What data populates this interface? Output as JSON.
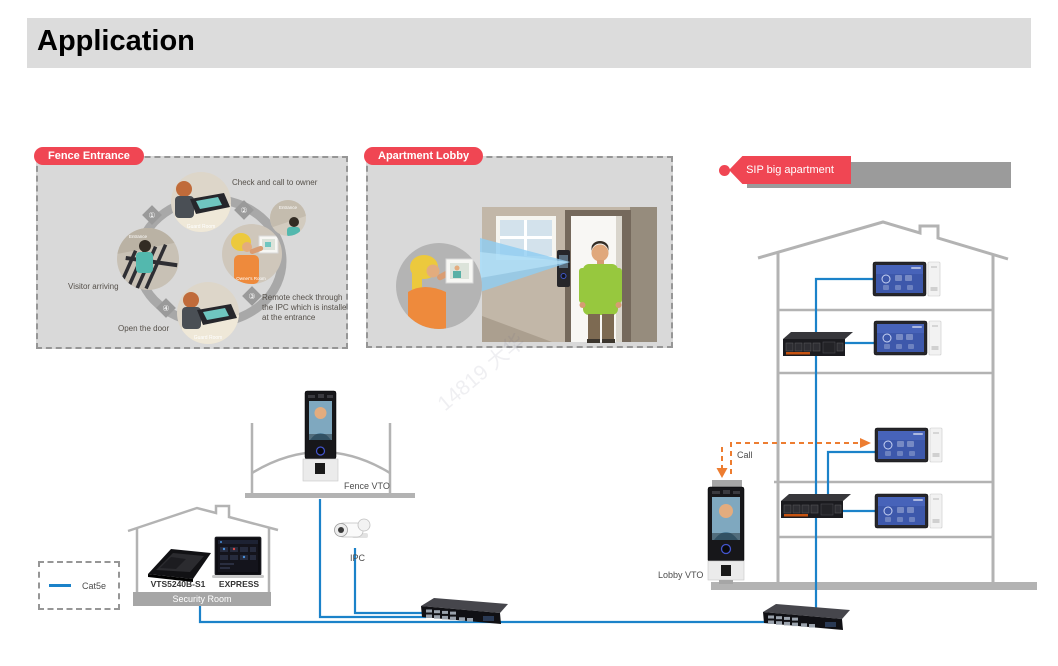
{
  "title": "Application",
  "watermark": "14819 大华",
  "colors": {
    "accent_red": "#f04653",
    "line_blue": "#1b82c9",
    "call_orange": "#ed7d31",
    "bar_gray": "#a6a6a6",
    "panel_gray": "#d9d9d9",
    "outline_gray": "#b3b3b3"
  },
  "panels": {
    "fence": {
      "label": "Fence Entrance",
      "steps": {
        "check": "Check and call to owner",
        "arriving": "Visitor arriving",
        "remote1": "Remote check through",
        "remote2": "the IPC which is installed",
        "remote3": "at the entrance",
        "open": "Open the door"
      },
      "nums": {
        "n1": "①",
        "n2": "②",
        "n3": "③",
        "n4": "④"
      },
      "captions": {
        "guard": "Guard Room",
        "entrance": "Entrance",
        "owner": "Owner's Room"
      }
    },
    "lobby": {
      "label": "Apartment Lobby"
    }
  },
  "sip": {
    "label": "SIP big apartment"
  },
  "building": {
    "call_label": "Call",
    "lobby_vto_label": "Lobby VTO"
  },
  "site": {
    "fence_vto_label": "Fence VTO",
    "ipc_label": "IPC"
  },
  "security": {
    "room_label": "Security Room",
    "vts_label": "VTS5240B-S1",
    "express_label": "EXPRESS"
  },
  "legend": {
    "cable_label": "Cat5e"
  }
}
